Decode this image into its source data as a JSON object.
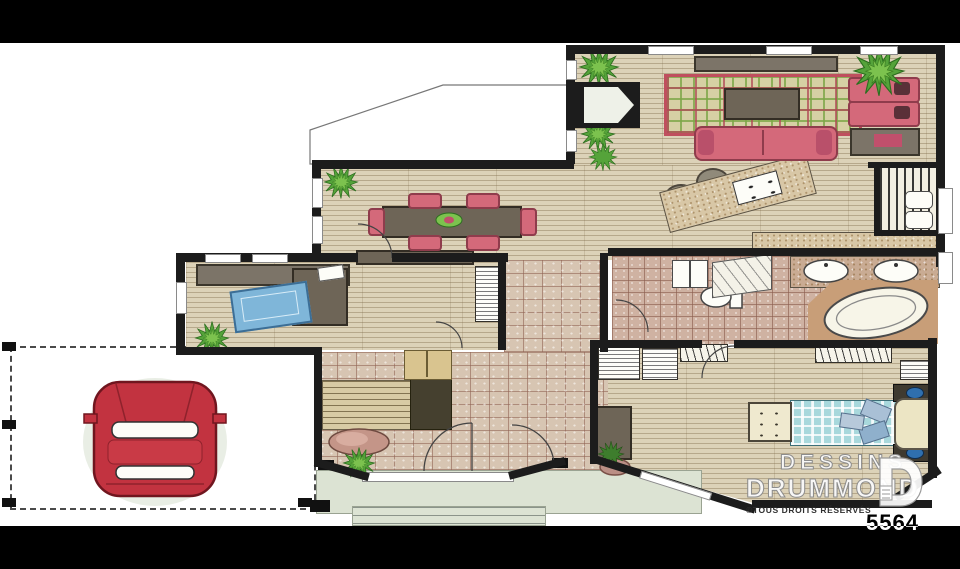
{
  "branding": {
    "studio_line1": "DESSINS",
    "studio_line2": "DRUMMOND",
    "rights": "©TOUS DROITS RÉSERVÉS"
  },
  "plan_number": "5564",
  "palette": {
    "wall": "#1c1c1c",
    "wood_floor": "#dcd2b8",
    "entry_tile": "#d7c5b2",
    "bath_tile": "#cfb2a2",
    "upholstery_pink": "#d4697a",
    "rug_red": "#bf4f5e",
    "rug_green": "#7ca646",
    "bed_teal": "#a8d8dc",
    "car_red": "#c23340",
    "porch_sage": "#dce3d3",
    "counter_granite": "#d8c7a6",
    "letterbox_bar": "#000000"
  }
}
